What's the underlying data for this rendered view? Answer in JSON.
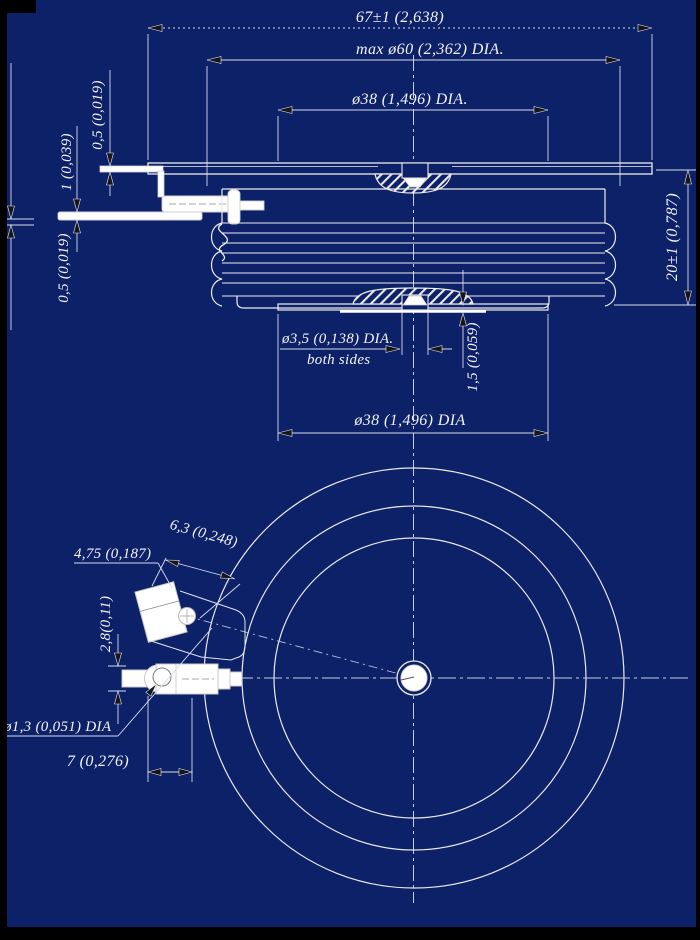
{
  "drawing": {
    "title": "disc-device-outline-drawing",
    "section_view": {
      "dim_flange_width": "67±1 (2,638)",
      "dim_ceramic_max": "max ø60 (2,362) DIA.",
      "dim_pole_top": "ø38 (1,496) DIA.",
      "dim_lead_thickness_top": "0,5 (0,019)",
      "dim_gate_terminal_thickness": "1 (0,039)",
      "dim_lead_thickness_bottom": "0,5 (0,019)",
      "dim_height": "20±1 (0,787)",
      "dim_center_hole": "ø3,5 (0,138) DIA.",
      "dim_center_hole_note": "both sides",
      "dim_face_step": "1,5 (0,059)",
      "dim_pole_bottom": "ø38 (1,496) DIA"
    },
    "bottom_view": {
      "dim_terminal_width": "4,75 (0,187)",
      "dim_terminal_length": "6,3 (0,248)",
      "dim_terminal_thickness": "2,8(0,11)",
      "dim_terminal_hole": "ø1,3 (0,051) DIA",
      "dim_terminal_offset": "7 (0,276)"
    },
    "colors": {
      "background": "#0d2169",
      "line": "#ededed",
      "dim_line": "#d8dcea",
      "centerline": "#c6cbdf",
      "arrow_fill": "#15151a",
      "scan_edge": "#000000"
    }
  }
}
